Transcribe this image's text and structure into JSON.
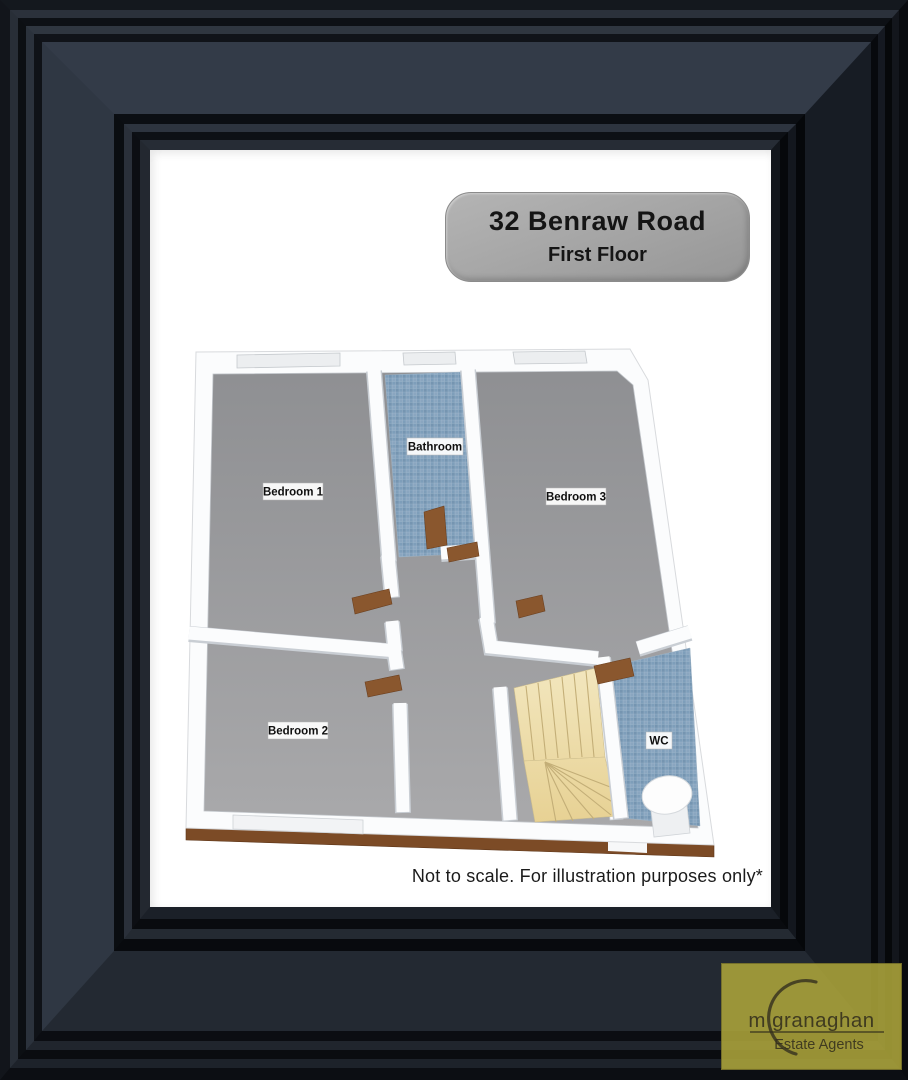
{
  "badge": {
    "line1": "32 Benraw Road",
    "line2": "First Floor"
  },
  "disclaimer": "Not to scale. For illustration purposes only*",
  "logo": {
    "name": "m granaghan",
    "tagline": "Estate Agents",
    "bg_color": "#aca43a",
    "text_color": "#332f1c"
  },
  "floorplan": {
    "floor_label": "First Floor",
    "rooms": [
      {
        "label": "Bedroom 1"
      },
      {
        "label": "Bathroom"
      },
      {
        "label": "Bedroom 3"
      },
      {
        "label": "Bedroom 2"
      },
      {
        "label": "WC"
      }
    ],
    "features": [
      "winder staircase",
      "toilet",
      "open doors with wood thresholds",
      "windows"
    ],
    "colors": {
      "room_floor": "#9a9a9c",
      "tile": "#7e9eba",
      "stairs": "#eddfae",
      "wood": "#7c4b26",
      "walls": "#fbfcfd"
    }
  },
  "frame": {
    "color": "#2b313b",
    "mat_color": "#ffffff"
  }
}
